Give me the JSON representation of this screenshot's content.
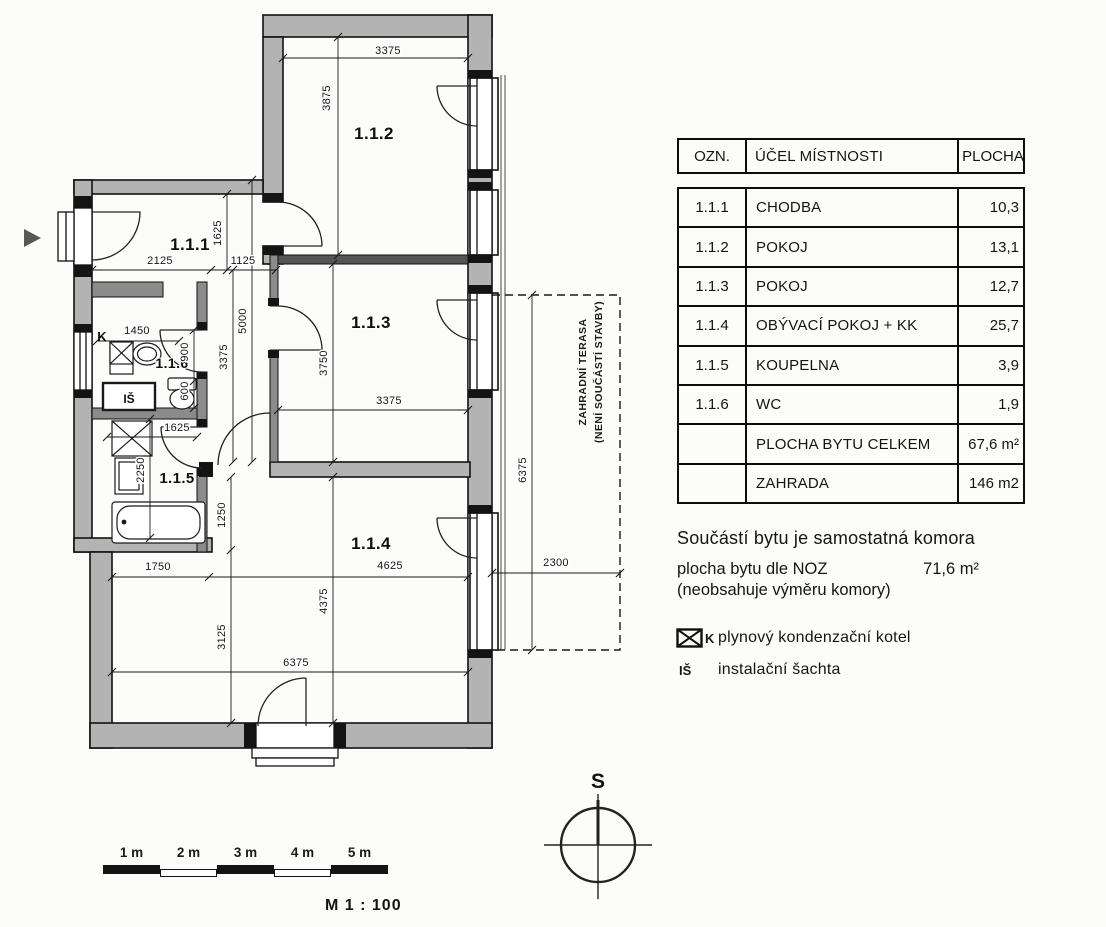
{
  "plan": {
    "room_labels": [
      {
        "text": "1.1.1",
        "x": 190,
        "y": 250,
        "size": 17
      },
      {
        "text": "1.1.2",
        "x": 374,
        "y": 139,
        "size": 17
      },
      {
        "text": "1.1.3",
        "x": 371,
        "y": 328,
        "size": 17
      },
      {
        "text": "1.1.4",
        "x": 371,
        "y": 549,
        "size": 17
      },
      {
        "text": "1.1.5",
        "x": 177,
        "y": 483,
        "size": 15
      },
      {
        "text": "1.1.6",
        "x": 172,
        "y": 368,
        "size": 14
      }
    ],
    "equipment_labels": [
      {
        "text": "K",
        "x": 102,
        "y": 341,
        "size": 13
      },
      {
        "text": "IŠ",
        "x": 129,
        "y": 403,
        "size": 12
      }
    ],
    "dimension_labels": [
      {
        "text": "3375",
        "x": 388,
        "y": 54
      },
      {
        "text": "3875",
        "x": 330,
        "y": 98,
        "rot": -90
      },
      {
        "text": "1625",
        "x": 221,
        "y": 233,
        "rot": -90
      },
      {
        "text": "2125",
        "x": 160,
        "y": 264
      },
      {
        "text": "1125",
        "x": 243,
        "y": 264
      },
      {
        "text": "5000",
        "x": 246,
        "y": 321,
        "rot": -90
      },
      {
        "text": "3375",
        "x": 227,
        "y": 357,
        "rot": -90
      },
      {
        "text": "1450",
        "x": 137,
        "y": 334
      },
      {
        "text": "900",
        "x": 188,
        "y": 352,
        "rot": -90
      },
      {
        "text": "600",
        "x": 188,
        "y": 391,
        "rot": -90
      },
      {
        "text": "1625",
        "x": 177,
        "y": 431
      },
      {
        "text": "2250",
        "x": 144,
        "y": 470,
        "rot": -90
      },
      {
        "text": "1250",
        "x": 225,
        "y": 515,
        "rot": -90
      },
      {
        "text": "3750",
        "x": 327,
        "y": 363,
        "rot": -90
      },
      {
        "text": "3375",
        "x": 389,
        "y": 404
      },
      {
        "text": "1750",
        "x": 158,
        "y": 570
      },
      {
        "text": "4625",
        "x": 390,
        "y": 569
      },
      {
        "text": "4375",
        "x": 327,
        "y": 601,
        "rot": -90
      },
      {
        "text": "3125",
        "x": 225,
        "y": 637,
        "rot": -90
      },
      {
        "text": "6375",
        "x": 296,
        "y": 666
      },
      {
        "text": "2300",
        "x": 556,
        "y": 566
      },
      {
        "text": "6375",
        "x": 526,
        "y": 470,
        "rot": -90
      }
    ],
    "terrace_label_line1": "ZAHRADNÍ TERASA",
    "terrace_label_line2": "(NENÍ SOUČÁSTÍ STAVBY)"
  },
  "legend_table": {
    "headers": [
      "OZN.",
      "ÚČEL MÍSTNOSTI",
      "PLOCHA"
    ],
    "rows": [
      [
        "1.1.1",
        "CHODBA",
        "10,3"
      ],
      [
        "1.1.2",
        "POKOJ",
        "13,1"
      ],
      [
        "1.1.3",
        "POKOJ",
        "12,7"
      ],
      [
        "1.1.4",
        "OBÝVACÍ POKOJ + KK",
        "25,7"
      ],
      [
        "1.1.5",
        "KOUPELNA",
        "3,9"
      ],
      [
        "1.1.6",
        "WC",
        "1,9"
      ],
      [
        "",
        "PLOCHA BYTU CELKEM",
        "67,6 m²"
      ],
      [
        "",
        "ZAHRADA",
        "146 m2"
      ]
    ]
  },
  "notes": {
    "line1": "Součástí bytu je samostatná komora",
    "line2_label": "plocha bytu dle NOZ",
    "line2_value": "71,6 m²",
    "line3": "(neobsahuje výměru komory)"
  },
  "symbol_legend": [
    {
      "symbol": "K",
      "text": "plynový kondenzační kotel"
    },
    {
      "symbol": "IŠ",
      "text": "instalační šachta"
    }
  ],
  "compass": {
    "north_label": "S"
  },
  "scale_bar": {
    "labels": [
      "1 m",
      "2 m",
      "3 m",
      "4 m",
      "5 m"
    ],
    "scale_label": "M 1 : 100"
  }
}
